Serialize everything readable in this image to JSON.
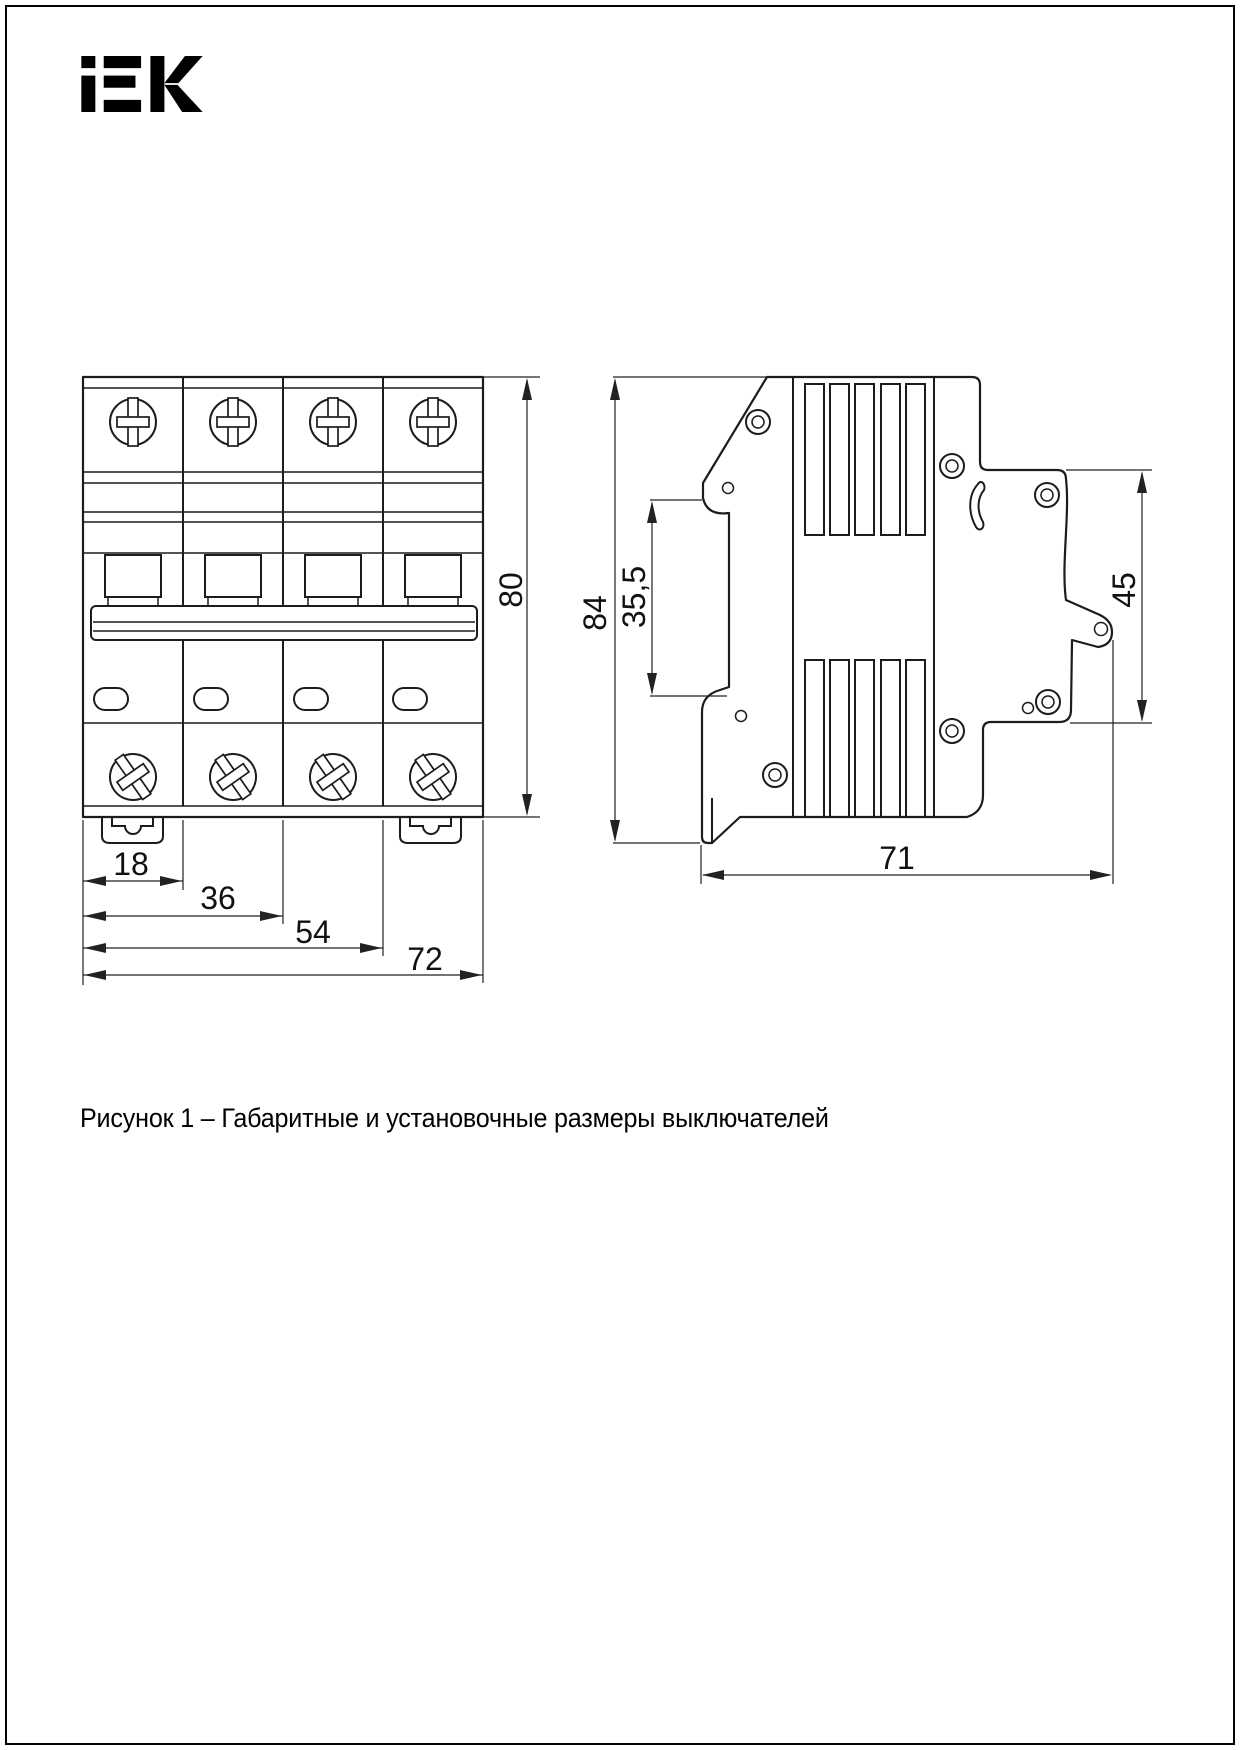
{
  "logo": {
    "text": "iEK"
  },
  "caption": "Рисунок 1 – Габаритные и установочные размеры выключателей",
  "dimensions": {
    "front": {
      "height": "80",
      "pole": "18",
      "two_poles": "36",
      "three_poles": "54",
      "total_width": "72"
    },
    "side": {
      "total_height": "84",
      "rail_notch": "35,5",
      "front_height": "45",
      "depth": "71"
    }
  }
}
